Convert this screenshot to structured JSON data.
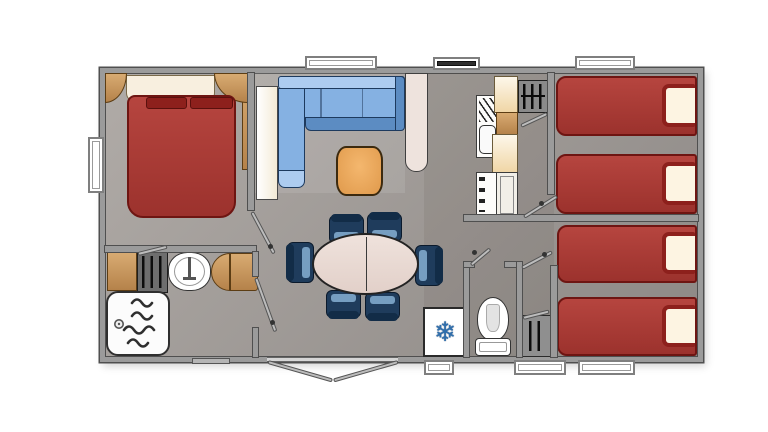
{
  "meta": {
    "type": "floor-plan",
    "subject": "Top-down colour floor plan of a mobile home / holiday caravan",
    "canvas": {
      "width": 768,
      "height": 432
    }
  },
  "icons": {
    "snowflake": "❄"
  },
  "colors": {
    "wall": "#9b9b9b",
    "wall-line": "#4f4f4f",
    "floor-a": "#b0aba7",
    "floor-b": "#8d8885",
    "bed-red": "#a93a33",
    "bed-red-deep": "#6e1512",
    "pillow-red": "#8d201c",
    "cream": "#f8efdf",
    "tan": "#cf9e64",
    "tan-deep": "#a8763a",
    "sofa-blue": "#85b1e2",
    "sofa-blue-light": "#adccf0",
    "sofa-blue-deep": "#5c8cc2",
    "sofa-line": "#1d3a5e",
    "table-orange": "#efa95f",
    "chair-navy": "#1f3c5c",
    "chair-blue": "#7fa8cc",
    "table-top": "#e9d9d3",
    "column-white": "#eee3dd",
    "white": "#fdfcfa",
    "appliance-grey": "#8a8a8a",
    "snow-blue": "#2f6fae",
    "ink": "#2b2b2b"
  },
  "rooms": [
    {
      "id": "master-bedroom",
      "position": "top-left",
      "furniture": [
        "double-bed",
        "headboard",
        "corner-shelf-left",
        "corner-shelf-right",
        "wardrobe"
      ]
    },
    {
      "id": "bathroom",
      "position": "bottom-left",
      "furniture": [
        "shower-tray",
        "washbasin",
        "vanity-cabinet",
        "towel-rack-unit"
      ]
    },
    {
      "id": "living-area",
      "position": "top-middle",
      "furniture": [
        "corner-sofa",
        "coffee-table",
        "partition-column",
        "tall-cabinet"
      ]
    },
    {
      "id": "dining-area",
      "position": "bottom-middle",
      "furniture": [
        "oval-dining-table",
        "six-chairs",
        "fridge"
      ]
    },
    {
      "id": "kitchen",
      "position": "middle",
      "furniture": [
        "sink-with-drainer",
        "worktop",
        "hob",
        "cooker",
        "oven"
      ]
    },
    {
      "id": "wc",
      "position": "bottom-middle-right",
      "furniture": [
        "toilet"
      ]
    },
    {
      "id": "twin-bedroom-top-right",
      "furniture": [
        "single-bed",
        "single-bed"
      ]
    },
    {
      "id": "twin-bedroom-bottom-right",
      "furniture": [
        "single-bed",
        "single-bed",
        "closet"
      ]
    }
  ],
  "openings": {
    "windows_top": 3,
    "windows_bottom": 3,
    "windows_left": 1,
    "entry": "double-french-door-bottom-centre",
    "interior_doors": 6,
    "step": "small-step-bottom-left"
  }
}
